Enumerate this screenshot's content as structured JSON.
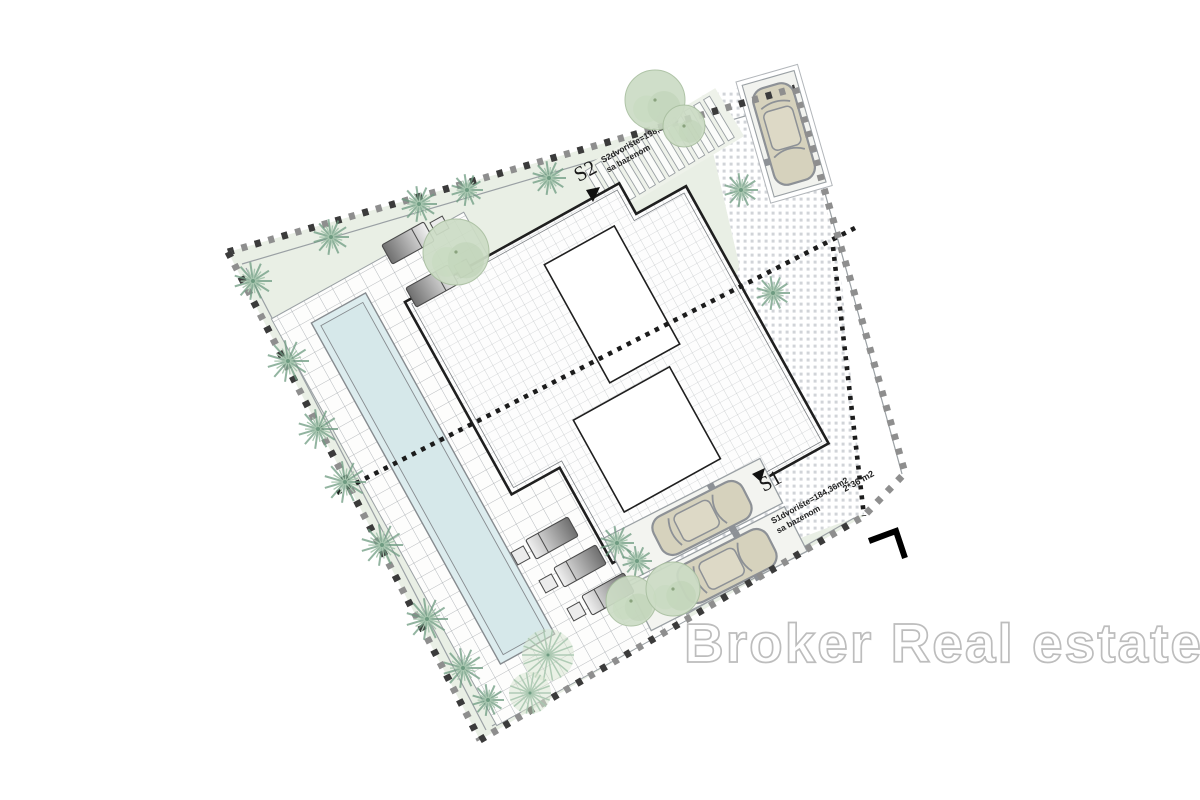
{
  "watermark": {
    "text": "Broker Real estate",
    "color": "#bdbdbd"
  },
  "parcels": {
    "s2": {
      "label": "S2",
      "area_line1": "S2dvorište=198,86m2",
      "area_line2": "sa bazenom"
    },
    "s1": {
      "label": "S1",
      "area_line1": "S1dvorište=184,36m2",
      "area_line2": "sa bazenom"
    }
  },
  "notes": {
    "parking_area": "2*36 m2"
  },
  "palette": {
    "plot_green": "#e9efe5",
    "deck_line": "#a3a8ac",
    "grid_line": "#b6babd",
    "pool_fill": "#dcecee",
    "pool_edge": "#868b8f",
    "building_line": "#1f1f1f",
    "dots": "#c9cdd1",
    "boundary_dark": "#3b3b3b",
    "boundary_gray": "#8e8e8e",
    "division_dots": "#1c1c1c",
    "palm_dark": "#6e9b81",
    "palm_light": "#a9c7b0",
    "tree_fill": "#ccdcc5",
    "tree_edge": "#a9bfa0",
    "fan_fill": "#d7e5cf",
    "car_body": "#d6d2bd",
    "car_line": "#8d9196"
  }
}
